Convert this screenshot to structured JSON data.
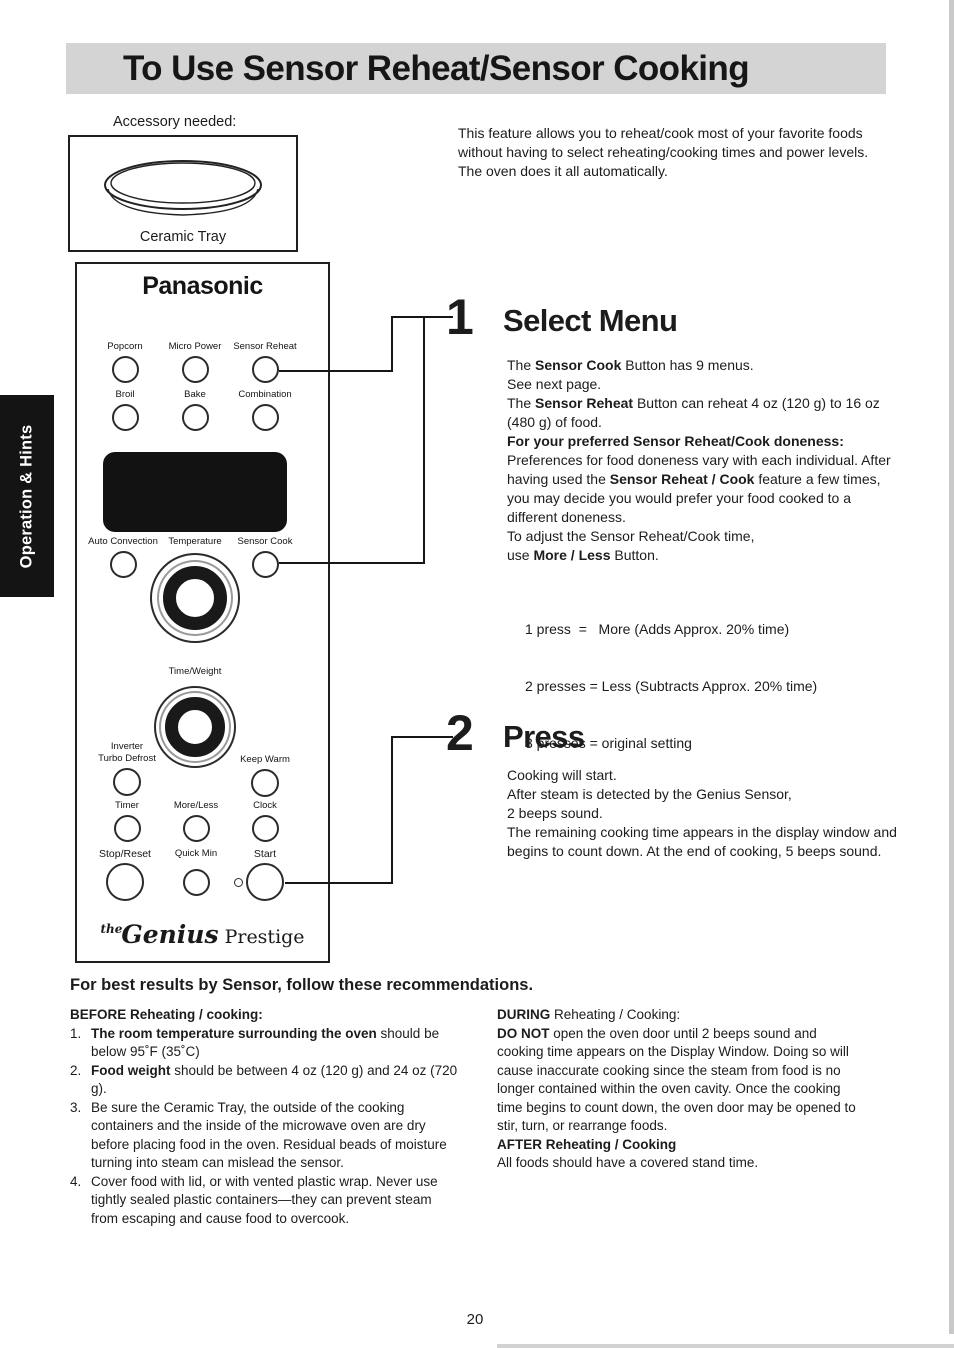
{
  "title": "To Use Sensor Reheat/Sensor Cooking",
  "sidebar_tab": "Operation & Hints",
  "accessory": {
    "label": "Accessory needed:",
    "name": "Ceramic Tray"
  },
  "intro": "This feature allows you to reheat/cook most of your favorite foods without having to select reheating/cooking times and power levels. The oven does it all automatically.",
  "colors": {
    "title_bar_bg": "#d4d4d4",
    "tab_bg": "#141414",
    "display_bg": "#121212"
  },
  "panel": {
    "brand": "Panasonic",
    "buttons": {
      "popcorn": "Popcorn",
      "micro_power": "Micro Power",
      "sensor_reheat": "Sensor Reheat",
      "broil": "Broil",
      "bake": "Bake",
      "combination": "Combination",
      "auto_convection": "Auto Convection",
      "temperature": "Temperature",
      "sensor_cook": "Sensor Cook",
      "time_weight": "Time/Weight",
      "inverter_line1": "Inverter",
      "inverter_line2": "Turbo Defrost",
      "keep_warm": "Keep Warm",
      "timer": "Timer",
      "more_less": "More/Less",
      "clock": "Clock",
      "stop_reset": "Stop/Reset",
      "quick_min": "Quick Min",
      "start": "Start"
    },
    "logo": {
      "the": "the",
      "genius": "Genius",
      "prestige": " Prestige"
    }
  },
  "steps": [
    {
      "number": "1",
      "heading": "Select Menu",
      "paragraphs": [
        [
          {
            "t": "The "
          },
          {
            "t": "Sensor Cook",
            "b": true
          },
          {
            "t": " Button has 9 menus."
          }
        ],
        [
          {
            "t": "See next page."
          }
        ],
        [
          {
            "t": "The "
          },
          {
            "t": "Sensor Reheat",
            "b": true
          },
          {
            "t": " Button can reheat 4 oz (120 g) to 16 oz (480 g) of food."
          }
        ],
        [
          {
            "t": "For your preferred Sensor Reheat/Cook doneness:",
            "b": true
          }
        ],
        [
          {
            "t": "Preferences for food doneness vary with each individual. After having used the "
          },
          {
            "t": "Sensor Reheat / Cook",
            "b": true
          },
          {
            "t": " feature a few times, you may decide you would prefer your food cooked to a different doneness."
          }
        ],
        [
          {
            "t": "To adjust the Sensor Reheat/Cook time,"
          }
        ],
        [
          {
            "t": "use "
          },
          {
            "t": "More / Less",
            "b": true
          },
          {
            "t": " Button."
          }
        ]
      ],
      "press_lines": [
        "1 press  =   More (Adds Approx. 20% time)",
        "2 presses = Less (Subtracts Approx. 20% time)",
        "3 presses = original setting"
      ]
    },
    {
      "number": "2",
      "heading": "Press",
      "paragraphs": [
        [
          {
            "t": "Cooking will start."
          }
        ],
        [
          {
            "t": "After steam is detected by the Genius Sensor,"
          }
        ],
        [
          {
            "t": "2 beeps sound."
          }
        ],
        [
          {
            "t": "The remaining cooking time appears in the display window and begins to count down. At the end of cooking, 5 beeps sound."
          }
        ]
      ]
    }
  ],
  "recommendations": {
    "heading": "For best results by Sensor, follow these recommendations.",
    "before": {
      "heading": [
        {
          "t": "BEFORE Reheating / cooking:",
          "b": true
        }
      ],
      "items": [
        {
          "num": "1.",
          "text": [
            {
              "t": "The room temperature surrounding the oven",
              "b": true
            },
            {
              "t": " should be below 95˚F (35˚C)"
            }
          ]
        },
        {
          "num": "2.",
          "text": [
            {
              "t": "Food weight",
              "b": true
            },
            {
              "t": " should be between 4 oz (120 g) and 24 oz (720 g)."
            }
          ]
        },
        {
          "num": "3.",
          "text": [
            {
              "t": "Be sure the Ceramic Tray, the outside of the cooking containers and the inside of the microwave oven are dry before placing food in the oven. Residual beads of moisture turning into steam can mislead the sensor."
            }
          ]
        },
        {
          "num": "4.",
          "text": [
            {
              "t": "Cover food with lid, or with vented plastic wrap. Never use tightly sealed plastic containers—they can prevent steam from escaping and cause food to overcook."
            }
          ]
        }
      ]
    },
    "during": {
      "p1": [
        {
          "t": "DURING",
          "b": true
        },
        {
          "t": " Reheating / Cooking:"
        }
      ],
      "p2": [
        {
          "t": "DO NOT",
          "b": true
        },
        {
          "t": " open the oven door until 2 beeps sound and cooking time appears on the Display Window. Doing so will cause inaccurate cooking since the steam from food is no longer contained within the oven cavity. Once the cooking time begins to count down, the oven door may be opened to stir, turn, or rearrange foods."
        }
      ],
      "after_heading": [
        {
          "t": "AFTER Reheating / Cooking",
          "b": true
        }
      ],
      "after_text": [
        {
          "t": "All foods should have a covered stand time."
        }
      ]
    }
  },
  "page_number": "20"
}
